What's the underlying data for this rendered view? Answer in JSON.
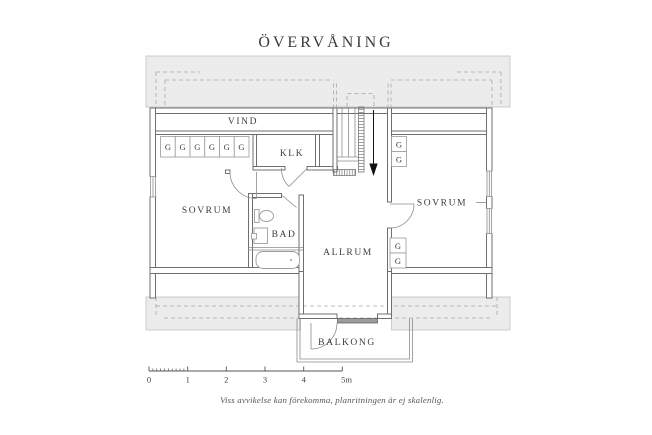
{
  "title": "ÖVERVÅNING",
  "rooms": {
    "vind": "VIND",
    "klk": "KLK",
    "sovrum_left": "SOVRUM",
    "sovrum_right": "SOVRUM",
    "bad": "BAD",
    "allrum": "ALLRUM",
    "balkong": "BALKONG"
  },
  "wardrobe_marker": "G",
  "scale_bar": {
    "labels": [
      "0",
      "1",
      "2",
      "3",
      "4",
      "5m"
    ],
    "unit_px_per_meter": 38.7
  },
  "disclaimer": "Viss avvikelse kan förekomma, planritningen är ej skalenlig.",
  "colors": {
    "wall": "#6f6f6f",
    "roof_band": "#ececec",
    "text": "#3b3b3b",
    "door_sill": "#9c9c9c"
  }
}
